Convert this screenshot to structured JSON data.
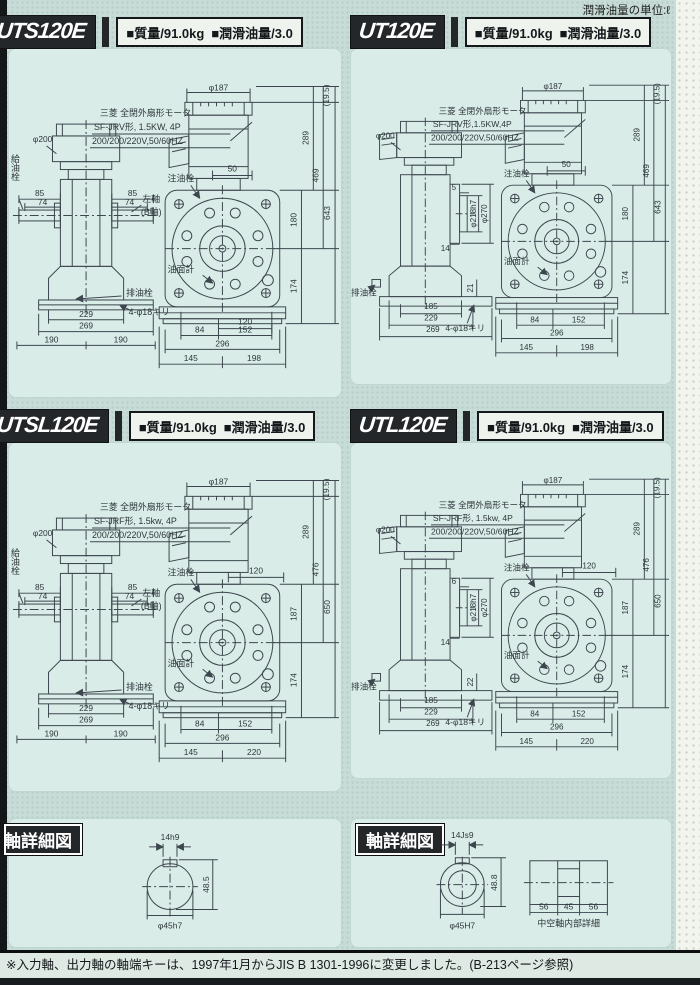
{
  "page": {
    "unit_note": "潤滑油量の単位:ℓ",
    "footer_note": "※入力軸、出力軸の軸端キーは、1997年1月からJIS B 1301-1996に変更しました。(B-213ページ参照)"
  },
  "panels": [
    {
      "model": "UTS120E",
      "spec_mass": "■質量/91.0kg",
      "spec_oil": "■潤滑油量/3.0",
      "note1": "三菱 全閉外扇形モータ",
      "note2": "SF-JRV形, 1.5KW, 4P",
      "note3": "200/200/220V,50/60HZ",
      "labels": {
        "phi200": "φ200",
        "phi187": "φ187",
        "paren": "(19.5)",
        "v289": "289",
        "vmid": "469",
        "vtall": "643",
        "vcase": "180",
        "v174": "174",
        "d50": "50",
        "d120": "120",
        "b84": "84",
        "b152": "152",
        "b296": "296",
        "b145": "145",
        "bright": "198",
        "s85l": "85",
        "s74l": "74",
        "s85r": "85",
        "s74r": "74",
        "leftshaft1": "左軸",
        "leftshaft2": "(B軸)",
        "filler": "給油栓",
        "inject": "注油栓",
        "gauge": "油面計",
        "drain": "排油栓",
        "holes": "4-φ18キリ",
        "sb229": "229",
        "sb269": "269",
        "sb190l": "190",
        "sb190r": "190"
      }
    },
    {
      "model": "UT120E",
      "spec_mass": "■質量/91.0kg",
      "spec_oil": "■潤滑油量/3.0",
      "note1": "三菱 全閉外扇形モータ",
      "note2": "SF-JRV形,1.5KW,4P",
      "note3": "200/200/220V,50/60HZ",
      "labels": {
        "phi200": "φ200",
        "phi187": "φ187",
        "paren": "(19.5)",
        "v289": "289",
        "vmid": "469",
        "vtall": "643",
        "vcase": "180",
        "v174": "174",
        "d50": "50",
        "b84": "84",
        "b152": "152",
        "b296": "296",
        "b145": "145",
        "bright": "198",
        "f5": "5",
        "f14": "14",
        "phi218": "φ218h7",
        "phi270": "φ270",
        "f21": "21",
        "inject": "注油栓",
        "gauge": "油面計",
        "drain": "排油栓",
        "holes": "4-φ18キリ",
        "sb185": "185",
        "sb229": "229",
        "sb269": "269"
      }
    },
    {
      "model": "UTSL120E",
      "spec_mass": "■質量/91.0kg",
      "spec_oil": "■潤滑油量/3.0",
      "note1": "三菱 全閉外扇形モータ",
      "note2": "SF-JRF形, 1.5kw, 4P",
      "note3": "200/200/220V,50/60HZ",
      "labels": {
        "phi200": "φ200",
        "phi187": "φ187",
        "paren": "(19.5)",
        "v289": "289",
        "vmid": "476",
        "vtall": "650",
        "vcase": "187",
        "v174": "174",
        "d120": "120",
        "b84": "84",
        "b152": "152",
        "b296": "296",
        "b145": "145",
        "bright": "220",
        "s85l": "85",
        "s74l": "74",
        "s85r": "85",
        "s74r": "74",
        "leftshaft1": "左軸",
        "leftshaft2": "(B軸)",
        "filler": "給油栓",
        "inject": "注油栓",
        "gauge": "油面計",
        "drain": "排油栓",
        "holes": "4-φ18キリ",
        "sb229": "229",
        "sb269": "269",
        "sb190l": "190",
        "sb190r": "190"
      }
    },
    {
      "model": "UTL120E",
      "spec_mass": "■質量/91.0kg",
      "spec_oil": "■潤滑油量/3.0",
      "note1": "三菱 全閉外扇形モータ",
      "note2": "SF-JRF形, 1.5kw, 4P",
      "note3": "200/200/220V,50/60HZ",
      "labels": {
        "phi200": "φ200",
        "phi187": "φ187",
        "paren": "(19.5)",
        "v289": "289",
        "vmid": "476",
        "vtall": "650",
        "vcase": "187",
        "v174": "174",
        "d120": "120",
        "b84": "84",
        "b152": "152",
        "b296": "296",
        "b145": "145",
        "bright": "220",
        "f5": "6",
        "f14": "14",
        "phi218": "φ218h7",
        "phi270": "φ270",
        "f21": "22",
        "inject": "注油栓",
        "gauge": "油面計",
        "drain": "排油栓",
        "holes": "4-φ18キリ",
        "sb185": "185",
        "sb229": "229",
        "sb269": "269"
      }
    }
  ],
  "shaft_details": {
    "left": {
      "title": "軸詳細図",
      "key": "14h9",
      "depth": "48.5",
      "dia": "φ45h7"
    },
    "right": {
      "title": "軸詳細図",
      "key": "14Js9",
      "depth": "48.8",
      "dia": "φ45H7",
      "seg1": "56",
      "seg2": "45",
      "seg3": "56",
      "caption": "中空軸内部詳細"
    }
  }
}
